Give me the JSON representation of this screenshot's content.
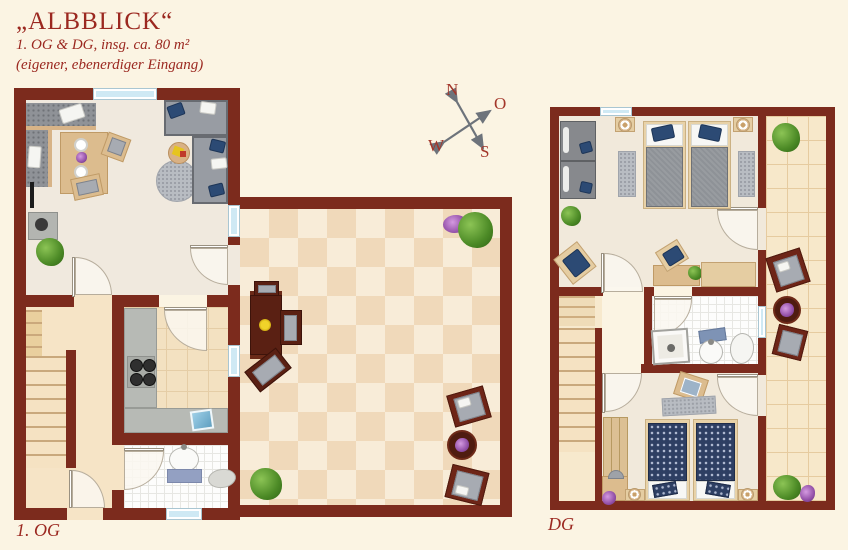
{
  "header": {
    "title": "„ALBBLICK“",
    "subtitle": "1. OG & DG, insg. ca. 80 m²",
    "note": "(eigener, ebenerdiger Eingang)"
  },
  "compass": {
    "north": "N",
    "east": "O",
    "west": "W",
    "south": "S"
  },
  "floors": {
    "og": {
      "label": "1. OG",
      "rooms": [
        "living-dining-room",
        "kitchen",
        "bathroom",
        "stair-hall",
        "terrace"
      ],
      "furniture": [
        "corner-bench",
        "dining-table",
        "chairs",
        "corner-sofa",
        "round-rug",
        "side-table",
        "stove",
        "plants",
        "kitchen-counter",
        "cooktop",
        "sink",
        "bath-sink",
        "bath-mat",
        "stairs",
        "terrace-table",
        "terrace-chairs",
        "armchairs",
        "round-table"
      ]
    },
    "dg": {
      "label": "DG",
      "rooms": [
        "bedroom-1",
        "bedroom-2",
        "bathroom",
        "stair-landing",
        "tiled-corridor"
      ],
      "furniture": [
        "wardrobes",
        "twin-beds-gray",
        "twin-beds-patterned",
        "nightstands",
        "lamps",
        "rugs",
        "desk",
        "desk-chair",
        "sideboard",
        "shower",
        "sink",
        "toilet",
        "armchairs",
        "round-table",
        "plants"
      ]
    }
  },
  "colors": {
    "background": "#fbf4e3",
    "wall": "#7c2b1d",
    "text_red": "#9b2820",
    "window_blue": "#cfe9f4",
    "terrace_tile_light": "#f8ecd8",
    "terrace_tile_dark": "#f0d9ba",
    "sofa_gray": "#989ca3",
    "navy_fabric": "#2c4a74",
    "wood_light": "#dcbc8e",
    "wood_dark": "#5a2013"
  }
}
